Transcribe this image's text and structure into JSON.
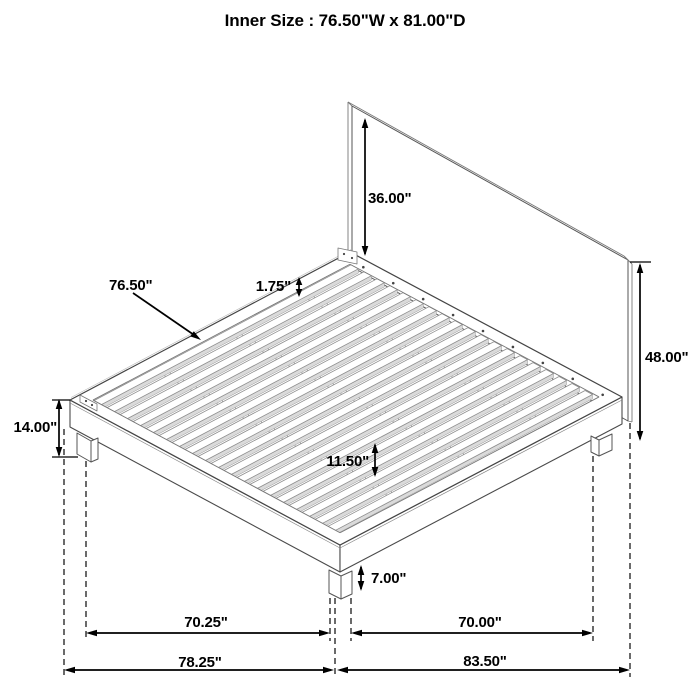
{
  "title": "Inner Size : 76.50\"W x 81.00\"D",
  "dimensions": {
    "headboard_above_deck": "36.00\"",
    "slat_length": "76.50\"",
    "slat_thickness": "1.75\"",
    "headboard_total_height": "48.00\"",
    "deck_height": "14.00\"",
    "under_bed_clearance": "11.50\"",
    "leg_height": "7.00\"",
    "leg_span_front": "70.25\"",
    "leg_span_side": "70.00\"",
    "overall_width": "78.25\"",
    "overall_depth": "83.50\""
  },
  "colors": {
    "background": "#ffffff",
    "outline": "#4a4a4a",
    "soft_line": "#8f8f8f",
    "inner_line": "#777777",
    "slat_shade": "#dadada",
    "dimension": "#000000"
  }
}
